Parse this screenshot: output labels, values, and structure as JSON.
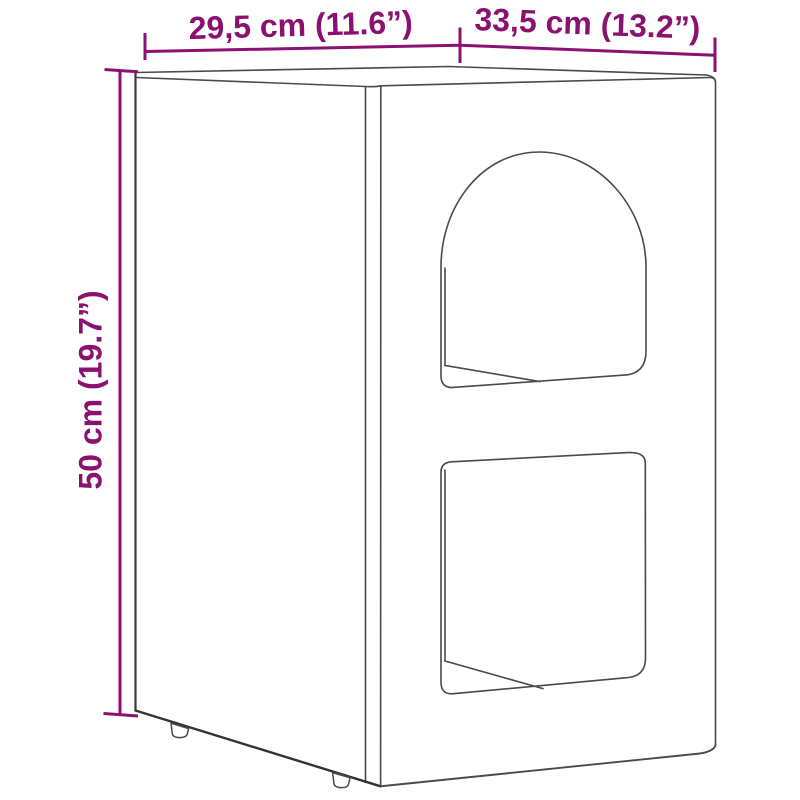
{
  "diagram": {
    "dimensions": {
      "top_left": "29,5 cm (11.6”)",
      "top_right": "33,5 cm (13.2”)",
      "left": "50 cm (19.7”)"
    },
    "colors": {
      "dimension_accent": "#8B1170",
      "line_art": "#4A4A4A",
      "line_art_heavy": "#333333",
      "background": "#FFFFFF"
    }
  }
}
